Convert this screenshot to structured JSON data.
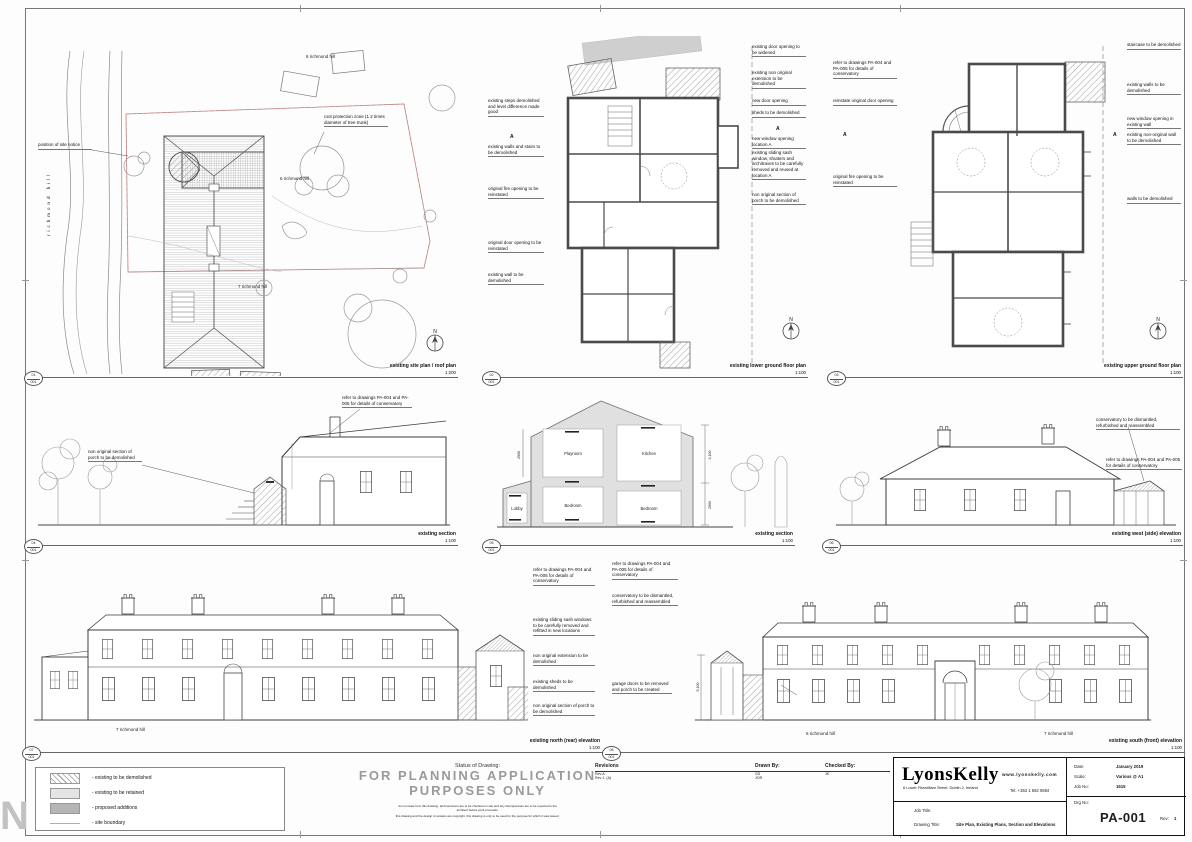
{
  "sheet": {
    "watermark": "N"
  },
  "icons": {
    "north_letter": "N"
  },
  "legend": {
    "items": [
      {
        "label": "- existing to be demolished"
      },
      {
        "label": "- existing to be retained"
      },
      {
        "label": "- proposed additions"
      },
      {
        "label": "- site boundary"
      }
    ]
  },
  "status": {
    "label": "Status of Drawing:",
    "line1": "FOR PLANNING APPLICATION",
    "line2": "PURPOSES ONLY",
    "small1": "do not scale from this drawing. all dimensions are to be checked on site and any discrepancies are to be reported to the architect before work proceeds.",
    "small2": "this drawing and the design it contains are copyright. this drawing is only to be used for the purpose for which it was issued."
  },
  "revisions": {
    "title": "Revisions",
    "row1": "Rev A.",
    "row2": "Rev 1.   (A)",
    "drawn_label": "Drawn By:",
    "drawn1": "GS",
    "drawn2": "JOR",
    "checked_label": "Checked By:",
    "checked": "JK"
  },
  "titleblock": {
    "firm": "LyonsKelly",
    "address": "6 Lower Fitzwilliam Street, Dublin 2, Ireland",
    "web": "www.lyonskelly.com",
    "tel": "Tel: +353 1 662 0884",
    "date_label": "Date:",
    "date": "January 2019",
    "scale_label": "Scale:",
    "scale": "Various @ A1",
    "job_label": "Job No:",
    "job": "1615",
    "drg_label": "Drg No:",
    "drg": "PA-001",
    "rev_label": "Rev:",
    "rev": "1",
    "job_title_label": "Job Title:",
    "drawing_title_label": "Drawing Title:",
    "drawing_title": "Site Plan, Existing Plans, Section and Elevations"
  },
  "panels": {
    "site": {
      "no": "01",
      "sh": "001",
      "title": "existing site plan / roof plan",
      "scale": "1:200",
      "road": "richmond hill",
      "n6a": "6 richmond hill",
      "n6b": "6 richmond hill",
      "n7": "7 richmond hill",
      "notice": "position of site notice",
      "rpz": "root protection zone (1.2 times diameter of tree trunk)"
    },
    "lower": {
      "no": "02",
      "sh": "001",
      "title": "existing lower ground floor plan",
      "scale": "1:100",
      "marker": "A",
      "left": [
        "existing steps demolished and level difference made good",
        "existing walls and stairs to be demolished",
        "original fire opening to be reinstated",
        "original door opening to be reinstated",
        "existing wall to be demolished"
      ],
      "right": [
        "existing door opening to be widened",
        "existing non original extension to be demolished",
        "new door opening",
        "sheds to be demolished",
        "new window opening location A",
        "existing sliding sash window, shutters and architraves to be carefully removed and reused at location A",
        "non original section of porch to be demolished"
      ]
    },
    "upper": {
      "no": "03",
      "sh": "001",
      "title": "existing upper ground floor plan",
      "scale": "1:100",
      "marker": "A",
      "left": [
        "refer to drawings PA-004 and PA-005 for details of conservatory",
        "reinstate original door opening",
        "original fire opening to be reinstated"
      ],
      "right": [
        "staircase to be demolished",
        "existing walls to be demolished",
        "new window opening in existing wall",
        "existing non-original wall to be demolished",
        "walls to be demolished"
      ]
    },
    "sec1": {
      "no": "04",
      "sh": "001",
      "title": "existing section",
      "scale": "1:100",
      "notes": [
        "refer to drawings PA-004 and PA-005 for details of conservatory",
        "non original section of porch to be demolished"
      ]
    },
    "sec2": {
      "no": "05",
      "sh": "001",
      "title": "existing section",
      "scale": "1:100",
      "rooms": [
        "Playroom",
        "Kitchen",
        "Lobby",
        "Bedroom",
        "Bedroom"
      ],
      "dims": [
        "2900",
        "3,100",
        "2900"
      ]
    },
    "west": {
      "no": "06",
      "sh": "001",
      "title": "existing west (side) elevation",
      "scale": "1:100",
      "notes": [
        "conservatory to be dismantled, refurbished and reassembled",
        "refer to drawings PA-004 and PA-005 for details of conservatory"
      ]
    },
    "north": {
      "no": "07",
      "sh": "001",
      "title": "existing north (rear) elevation",
      "scale": "1:100",
      "house": "7 richmond hill",
      "notes": [
        "refer to drawings PA-004 and PA-005 for details of conservatory",
        "existing sliding sash windows to be carefully removed and refitted in new locations",
        "non original extension to be demolished",
        "existing sheds to be demolished",
        "non original section of porch to be demolished"
      ]
    },
    "south": {
      "no": "08",
      "sh": "001",
      "title": "existing south (front) elevation",
      "scale": "1:100",
      "house1": "6 richmond hill",
      "house2": "7 richmond hill",
      "dim": "5,100",
      "notes": [
        "refer to drawings PA-004 and PA-005 for details of conservatory",
        "conservatory to be dismantled, refurbished and reassembled",
        "garage doors to be removed and porch to be created"
      ]
    }
  }
}
